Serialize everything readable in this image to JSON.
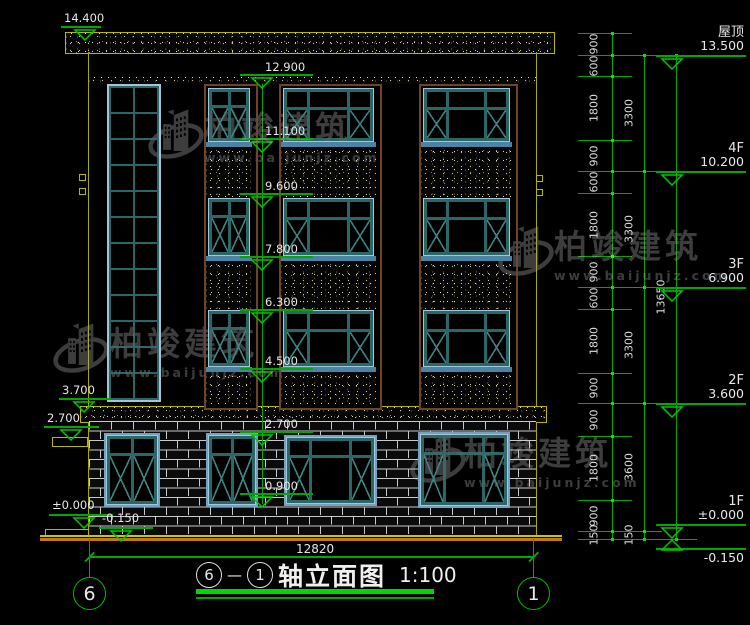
{
  "drawing": {
    "title_block": {
      "axis_left": "6",
      "dash": "—",
      "axis_right": "1",
      "name": "轴立面图",
      "scale": "1:100"
    },
    "bottom_dimension": "12820",
    "axis_bubbles": {
      "left": "6",
      "right": "1"
    }
  },
  "left_markers": [
    "14.400",
    "3.700",
    "2.700",
    "±0.000",
    "-0.150"
  ],
  "mid_markers": [
    "12.900",
    "11.100",
    "9.600",
    "7.800",
    "6.300",
    "4.500",
    "2.700",
    "0.900"
  ],
  "right_chain_segments": [
    "900",
    "600",
    "1800",
    "900",
    "600",
    "1800",
    "900",
    "600",
    "1800",
    "900",
    "900",
    "1800",
    "900",
    "150"
  ],
  "right_floor_segments": [
    "3300",
    "3300",
    "3300",
    "3600",
    "150"
  ],
  "right_total": "13650",
  "floor_levels": [
    {
      "label": "屋顶",
      "elevation": "13.500"
    },
    {
      "label": "4F",
      "elevation": "10.200"
    },
    {
      "label": "3F",
      "elevation": "6.900"
    },
    {
      "label": "2F",
      "elevation": "3.600"
    },
    {
      "label": "1F",
      "elevation": "±0.000"
    }
  ],
  "below_ground_level": {
    "elevation": "-0.150"
  },
  "watermark": {
    "brand": "柏竣建筑",
    "url": "www.baijunjz.com"
  },
  "colors": {
    "dim_green": "#00b400",
    "cad_yellow": "#b8b800",
    "frame_teal": "#2a6868",
    "text_white": "#e8e8e8",
    "watermark_gray": "#3d3d3d",
    "ground_orange": "#c07818"
  }
}
